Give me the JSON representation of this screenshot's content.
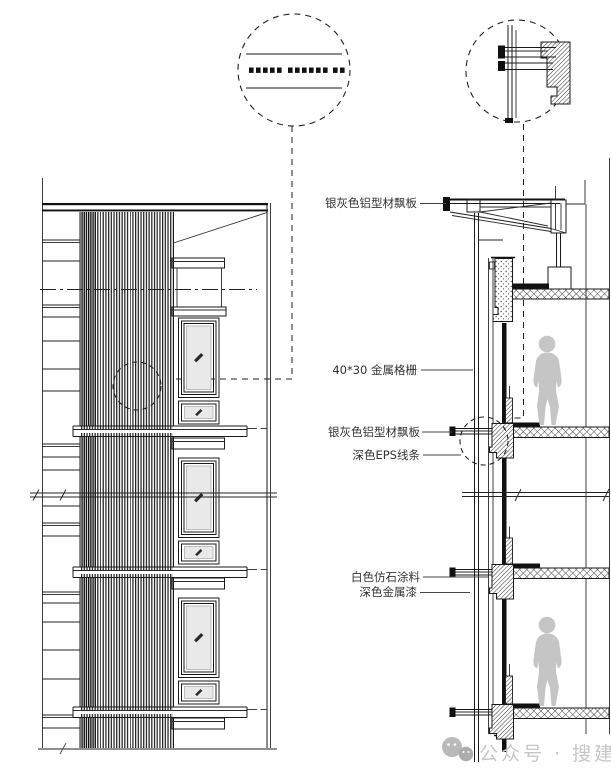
{
  "watermark": {
    "icon": "wechat-icon",
    "text": "公众号 · 搜建筑",
    "color": "#c6c6c6"
  },
  "annotations": {
    "labels": [
      {
        "id": "aluminum-fin-board-top",
        "text": "银灰色铝型材飘板"
      },
      {
        "id": "metal-grille",
        "text": "40*30 金属格栅"
      },
      {
        "id": "aluminum-fin-board-mid",
        "text": "银灰色铝型材飘板"
      },
      {
        "id": "dark-eps-trim",
        "text": "深色EPS线条"
      },
      {
        "id": "white-stone-paint",
        "text": "白色仿石涂料"
      },
      {
        "id": "dark-metal-paint",
        "text": "深色金属漆"
      }
    ]
  },
  "drawing": {
    "type": "architectural-facade-detail",
    "views": [
      "facade-elevation",
      "wall-section",
      "grille-plan-detail",
      "board-section-detail"
    ],
    "colors": {
      "line": "#1a1a1a",
      "glazing": "#e9e9e9",
      "figure": "#c5c5c5",
      "watermark": "#c6c6c6"
    }
  }
}
